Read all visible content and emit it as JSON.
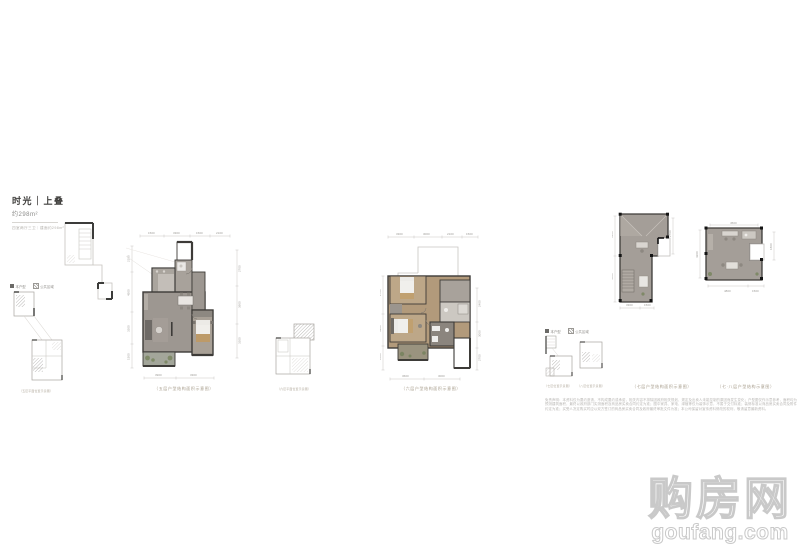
{
  "header": {
    "title": "时光｜上叠",
    "area": "约298m²",
    "subtitle": "四室两厅三卫｜建面约298m²"
  },
  "legend": {
    "item1": "本户型",
    "item2": "公共区域"
  },
  "plans": {
    "p1": {
      "caption": "（五层户型结构面积示意图）",
      "dims_top": [
        "1500",
        "3300",
        "1500",
        "2100"
      ],
      "dims_right": [
        "2700",
        "3900",
        "3300"
      ],
      "dims_bottom": [
        "3900",
        "3300"
      ],
      "dims_left": [
        "2100",
        "4500",
        "3300",
        "1500"
      ]
    },
    "p2": {
      "caption": "（六层户型结构面积示意图）",
      "dims_top": [
        "3300",
        "3000",
        "2100",
        "1500"
      ],
      "dims_right": [
        "2400",
        "3000",
        "2700"
      ],
      "dims_bottom": [
        "3600",
        "3000"
      ],
      "dims_left": [
        "2700",
        "3900",
        "1800"
      ]
    },
    "p3": {
      "caption": "（七层户型结构面积示意图）",
      "dims_left": [
        "3300",
        "4500"
      ],
      "dims_bottom": [
        "3300",
        "1500"
      ],
      "dims_right": [
        "2700"
      ]
    },
    "p4": {
      "caption": "（七·八层户型结构示意图）",
      "dims_top": [
        "4500"
      ],
      "dims_left": [
        "4200"
      ],
      "dims_right": [
        "1800"
      ],
      "dims_bottom": [
        "4800",
        "1500"
      ]
    }
  },
  "keyplans": {
    "k1": {
      "caption": "（五层平面位置示意图）"
    },
    "k2": {
      "caption": "（六层平面位置示意图）"
    },
    "k3": {
      "caption": "（七层位置示意图）"
    },
    "k4": {
      "caption": "（八层位置示意图）"
    }
  },
  "disclaimer": "免责声明：本资料仅为要约邀请，不构成要约或承诺，相关内容不排除因政府相关规划、规定及出卖人未能控制的原因而发生变化；户型图仅作示意参考，面积均为预测建筑面积，最终以政府部门实测面积及商品房买卖合同约定为准；图中家具、家电、绿植等仅为装饰示意，不属于交付标准；装修标准以商品房买卖合同及附件约定为准；买受人决定购买时应以双方签订的商品房买卖合同及政府最终审批文件为准；本公司保留对宣传资料修改的权利，敬请留意最新资料。",
  "watermark": {
    "cn": "购房网",
    "en": "goufang.com"
  }
}
